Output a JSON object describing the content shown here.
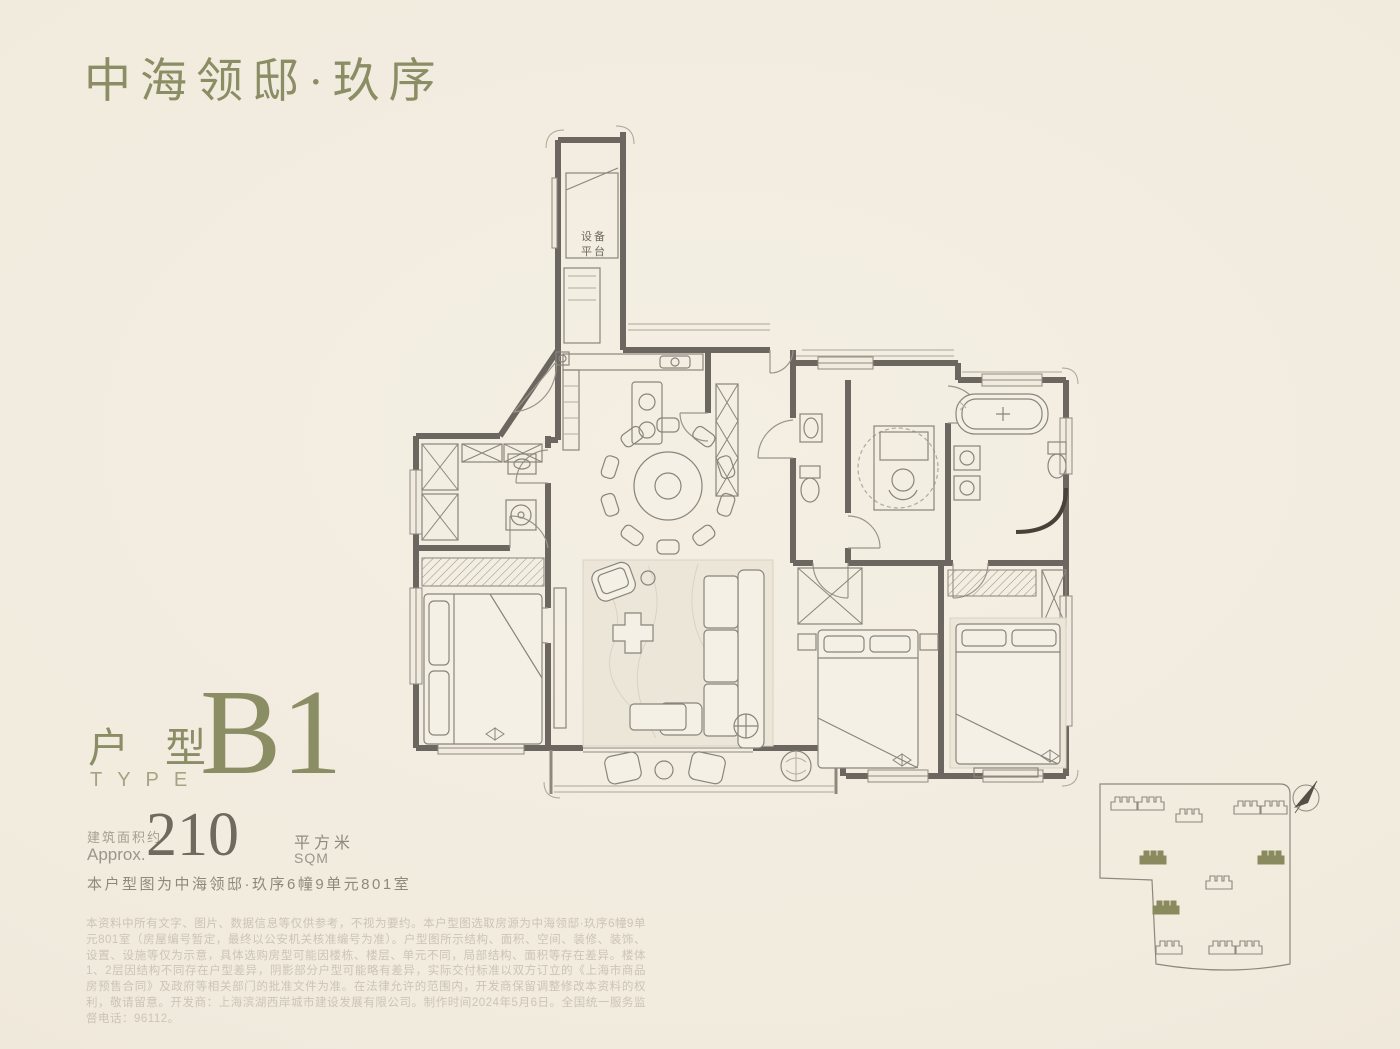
{
  "colors": {
    "background": "#f1ebdf",
    "accent_olive": "#8b8e64",
    "wall": "#6b665f",
    "light_line": "#8f8a80",
    "muted_text": "#9b958a",
    "faint_text": "#ccc5b5",
    "site_highlight": "#8a8a5f"
  },
  "header": {
    "title": "中海领邸·玖序"
  },
  "unit_card": {
    "type_label_cn": "户型",
    "type_label_en": "TYPE",
    "type_code": "B1",
    "area_label_cn": "建筑面积约",
    "area_label_en": "Approx.",
    "area_value": "210",
    "area_unit_cn": "平方米",
    "area_unit_en": "SQM",
    "location_note": "本户型图为中海领邸·玖序6幢9单元801室"
  },
  "floorplan": {
    "equipment_platform_line1": "设备",
    "equipment_platform_line2": "平台"
  },
  "site_plan": {
    "highlighted_building_count": 3,
    "compass": "north-arrow"
  },
  "disclaimer": "本资料中所有文字、图片、数据信息等仅供参考，不视为要约。本户型图选取房源为中海领邸·玖序6幢9单元801室（房屋编号暂定，最终以公安机关核准编号为准）。户型图所示结构、面积、空间、装修、装饰、设置、设施等仅为示意，具体选购房型可能因楼栋、楼层、单元不同，局部结构、面积等存在差异。楼体1、2层因结构不同存在户型差异，阴影部分户型可能略有差异，实际交付标准以双方订立的《上海市商品房预售合同》及政府等相关部门的批准文件为准。在法律允许的范围内，开发商保留调整修改本资料的权利，敬请留意。开发商：上海滨湖西岸城市建设发展有限公司。制作时间2024年5月6日。全国统一服务监督电话：96112。"
}
